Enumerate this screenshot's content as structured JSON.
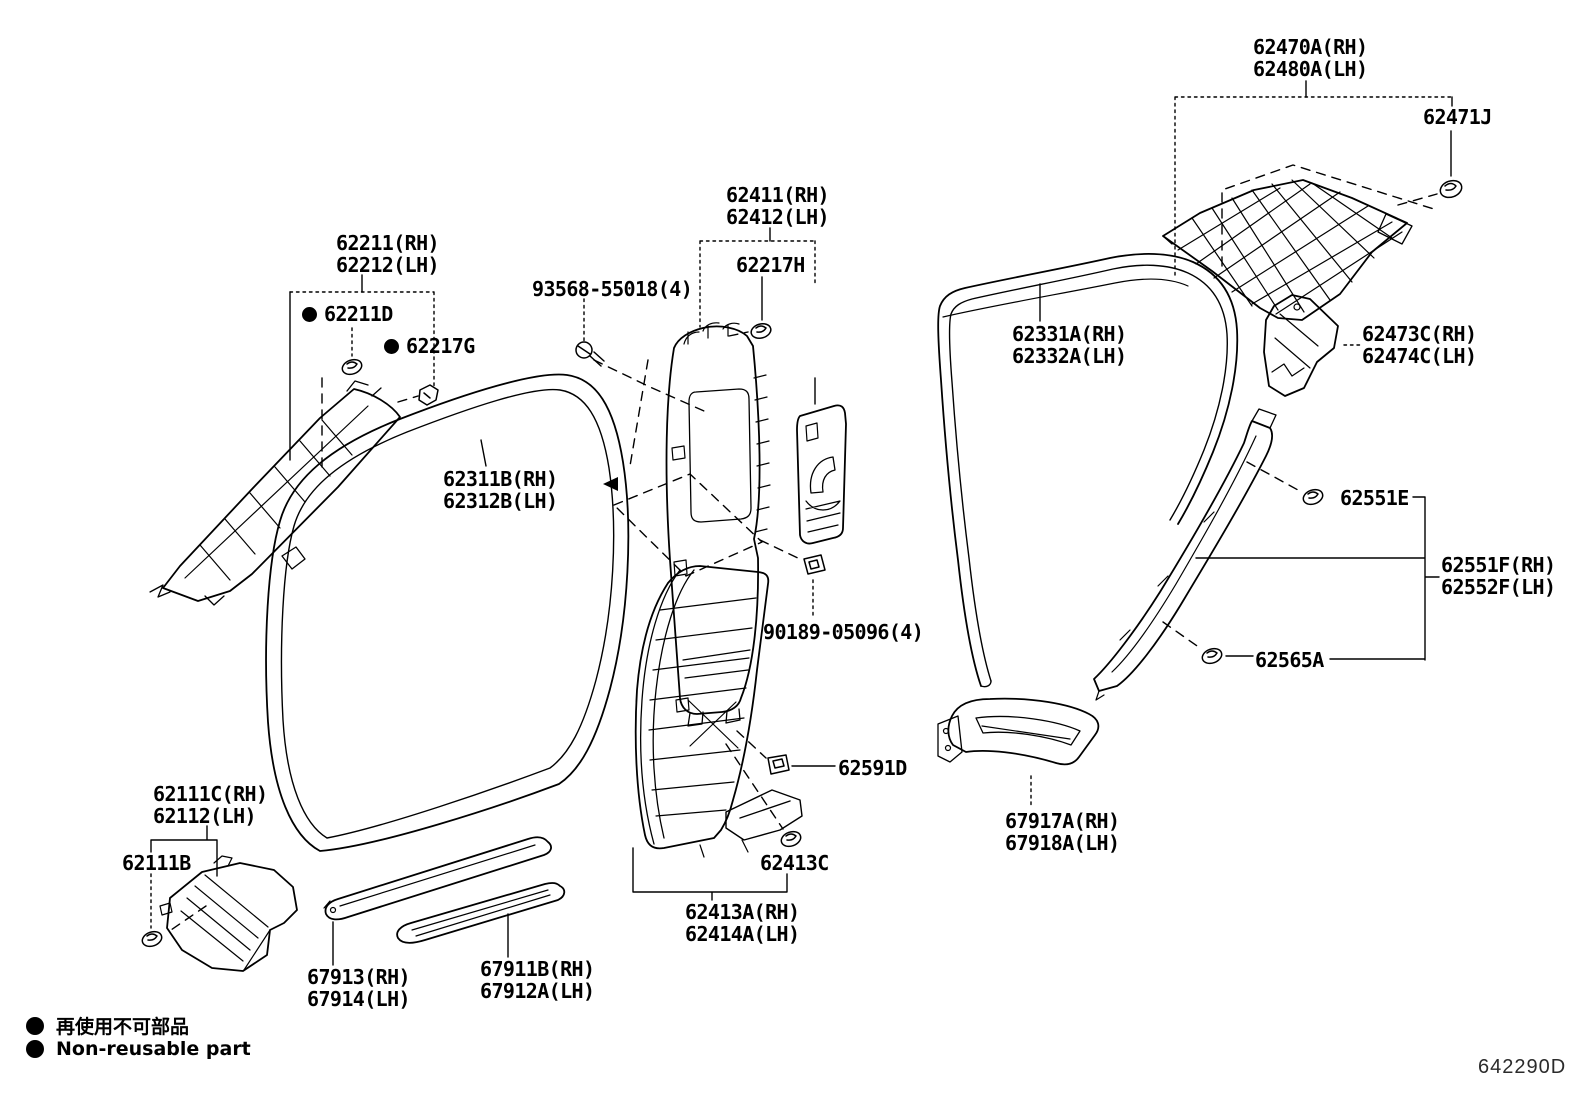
{
  "figure_code": "642290D",
  "legend": {
    "ja": "再使用不可部品",
    "en": "Non-reusable part"
  },
  "parts": {
    "p62470": {
      "l1": "62470A(RH)",
      "l2": "62480A(LH)"
    },
    "p62471J": {
      "l1": "62471J"
    },
    "p62411": {
      "l1": "62411(RH)",
      "l2": "62412(LH)"
    },
    "p62217H": {
      "l1": "62217H"
    },
    "p93568": {
      "l1": "93568-55018(4)"
    },
    "p62211": {
      "l1": "62211(RH)",
      "l2": "62212(LH)"
    },
    "p62211D": {
      "l1": "62211D"
    },
    "p62217G": {
      "l1": "62217G"
    },
    "refer": {
      "l1": "REFER TO",
      "l2": "FIG 71-04",
      "l3": "(PNC 73023(RH))",
      "l4": "(PNC 73024(LH))"
    },
    "p62331A": {
      "l1": "62331A(RH)",
      "l2": "62332A(LH)"
    },
    "p62473C": {
      "l1": "62473C(RH)",
      "l2": "62474C(LH)"
    },
    "p62311B": {
      "l1": "62311B(RH)",
      "l2": "62312B(LH)"
    },
    "p62551E": {
      "l1": "62551E"
    },
    "p62551F": {
      "l1": "62551F(RH)",
      "l2": "62552F(LH)"
    },
    "p90189": {
      "l1": "90189-05096(4)"
    },
    "p62565A": {
      "l1": "62565A"
    },
    "p62591D": {
      "l1": "62591D"
    },
    "p67917A": {
      "l1": "67917A(RH)",
      "l2": "67918A(LH)"
    },
    "p62413C": {
      "l1": "62413C"
    },
    "p62111C": {
      "l1": "62111C(RH)",
      "l2": "62112(LH)"
    },
    "p62111B": {
      "l1": "62111B"
    },
    "p62413A": {
      "l1": "62413A(RH)",
      "l2": "62414A(LH)"
    },
    "p67913": {
      "l1": "67913(RH)",
      "l2": "67914(LH)"
    },
    "p67911B": {
      "l1": "67911B(RH)",
      "l2": "67912A(LH)"
    }
  }
}
